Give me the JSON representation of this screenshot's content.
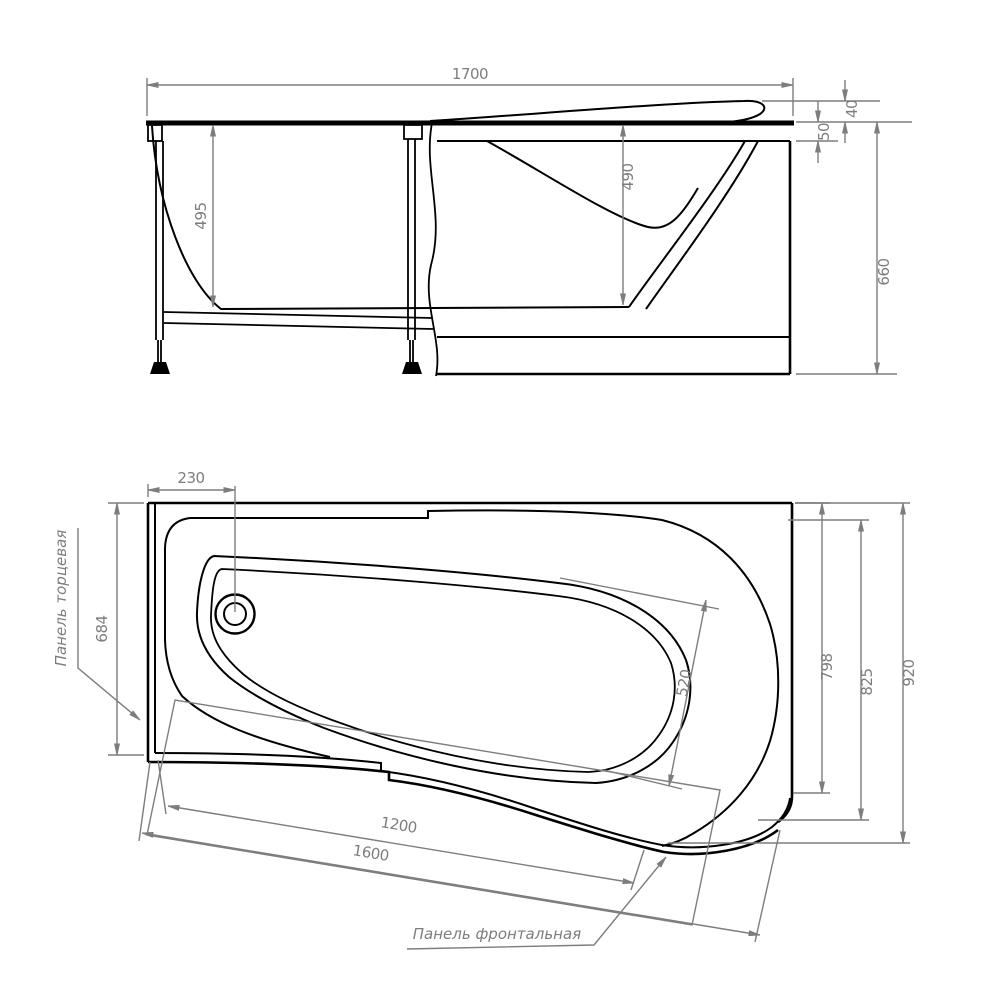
{
  "drawing": {
    "kind": "bathtub technical dimension drawing",
    "views": [
      "side elevation with mounting frame",
      "top plan with panels"
    ]
  },
  "side_view": {
    "dims": {
      "overall_length": "1700",
      "inner_height_left": "495",
      "inner_depth": "490",
      "headrest_rise": "40",
      "rim_height": "50",
      "overall_height": "660"
    }
  },
  "plan_view": {
    "dims": {
      "drain_offset": "230",
      "end_width": "684",
      "basin_width": "520",
      "width_inner": "798",
      "width_mid": "825",
      "overall_width": "920",
      "front_panel_length": "1200",
      "overall_length": "1600"
    },
    "labels": {
      "end_panel": "Панель торцевая",
      "front_panel": "Панель фронтальная"
    }
  },
  "colors": {
    "line": "#000000",
    "dimension": "#7d7d7d",
    "background": "#ffffff"
  }
}
